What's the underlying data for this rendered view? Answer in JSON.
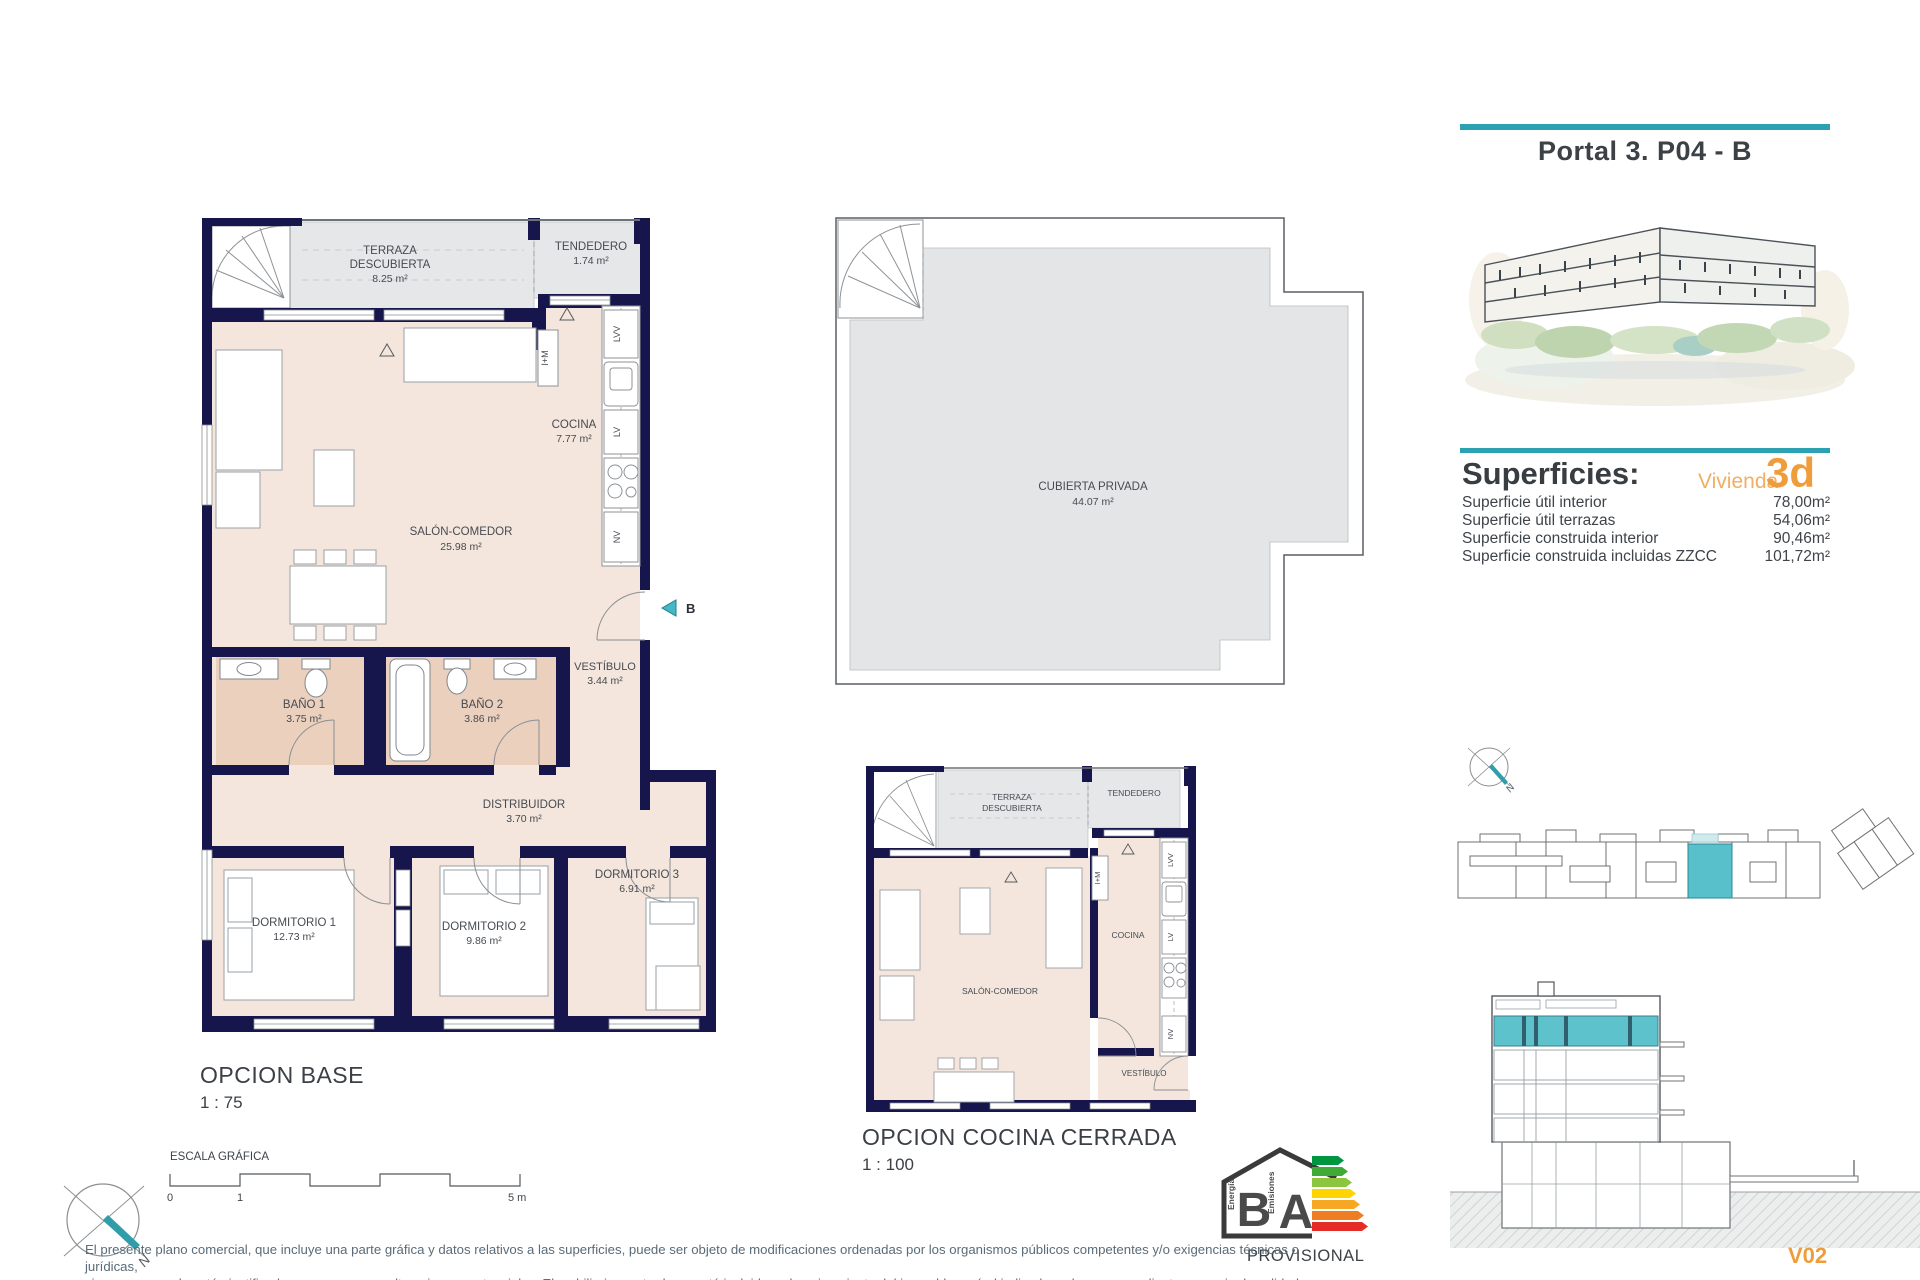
{
  "header": {
    "title": "Portal 3. P04 - B"
  },
  "superficies": {
    "heading": "Superficies:",
    "vivienda_label": "Vivienda",
    "vivienda_code": "3d",
    "rows": [
      {
        "label": "Superficie útil interior",
        "value": "78,00m²"
      },
      {
        "label": "Superficie útil terrazas",
        "value": "54,06m²"
      },
      {
        "label": "Superficie construida interior",
        "value": "90,46m²"
      },
      {
        "label": "Superficie construida incluidas ZZCC",
        "value": "101,72m²"
      }
    ]
  },
  "base_plan": {
    "title": "OPCION BASE",
    "scale": "1 : 75",
    "entrance_label": "B",
    "rooms": {
      "terraza": {
        "line1": "TERRAZA",
        "line2": "DESCUBIERTA",
        "area": "8.25 m²"
      },
      "tendedero": {
        "line1": "TENDEDERO",
        "area": "1.74 m²"
      },
      "cocina": {
        "line1": "COCINA",
        "area": "7.77 m²"
      },
      "salon": {
        "line1": "SALÓN-COMEDOR",
        "area": "25.98 m²"
      },
      "vestibulo": {
        "line1": "VESTÍBULO",
        "area": "3.44 m²"
      },
      "bano1": {
        "line1": "BAÑO 1",
        "area": "3.75 m²"
      },
      "bano2": {
        "line1": "BAÑO 2",
        "area": "3.86 m²"
      },
      "distribuidor": {
        "line1": "DISTRIBUIDOR",
        "area": "3.70 m²"
      },
      "dormitorio1": {
        "line1": "DORMITORIO 1",
        "area": "12.73 m²"
      },
      "dormitorio2": {
        "line1": "DORMITORIO 2",
        "area": "9.86 m²"
      },
      "dormitorio3": {
        "line1": "DORMITORIO 3",
        "area": "6.91 m²"
      }
    },
    "appliances": {
      "lvv": "LVV",
      "lv": "LV",
      "nv": "NV",
      "im": "I+M"
    }
  },
  "roof_plan": {
    "cubierta": {
      "line1": "CUBIERTA PRIVADA",
      "area": "44.07 m²"
    }
  },
  "kitchen_plan": {
    "title": "OPCION COCINA CERRADA",
    "scale": "1 : 100",
    "rooms": {
      "terraza": {
        "line1": "TERRAZA",
        "line2": "DESCUBIERTA"
      },
      "tendedero": {
        "line1": "TENDEDERO"
      },
      "cocina": {
        "line1": "COCINA"
      },
      "salon": {
        "line1": "SALÓN-COMEDOR"
      },
      "vestibulo": {
        "line1": "VESTÍBULO"
      }
    },
    "appliances": {
      "lvv": "LVV",
      "lv": "LV",
      "nv": "NV",
      "im": "I+M"
    }
  },
  "scale_bar": {
    "label": "ESCALA GRÁFICA",
    "tick0": "0",
    "tick1": "1",
    "tick5": "5 m"
  },
  "compass": {
    "north": "N"
  },
  "energy_label": {
    "left_letter": "B",
    "right_letter": "A",
    "left_caption": "Energía",
    "right_caption": "Emisiones",
    "status": "PROVISIONAL"
  },
  "footer": {
    "disclaimer_line1": "El presente plano comercial, que incluye una parte gráfica y datos relativos a las superficies, puede ser objeto de modificaciones ordenadas por los organismos públicos competentes y/o exigencias técnicas o jurídicas,",
    "disclaimer_line2": "siempre y cuando estén justificados y no supongan alteraciones sustanciales. El mobiliario mostrado no está incluido y el equipamiento del inmueble será el indicado en la correspondiente memoria de calidades",
    "version": "V02"
  },
  "colors": {
    "accent_teal": "#2ba1b1",
    "unit_highlight": "#58c0cb",
    "accent_orange": "#ef9c3a",
    "wall_navy": "#16164c"
  }
}
